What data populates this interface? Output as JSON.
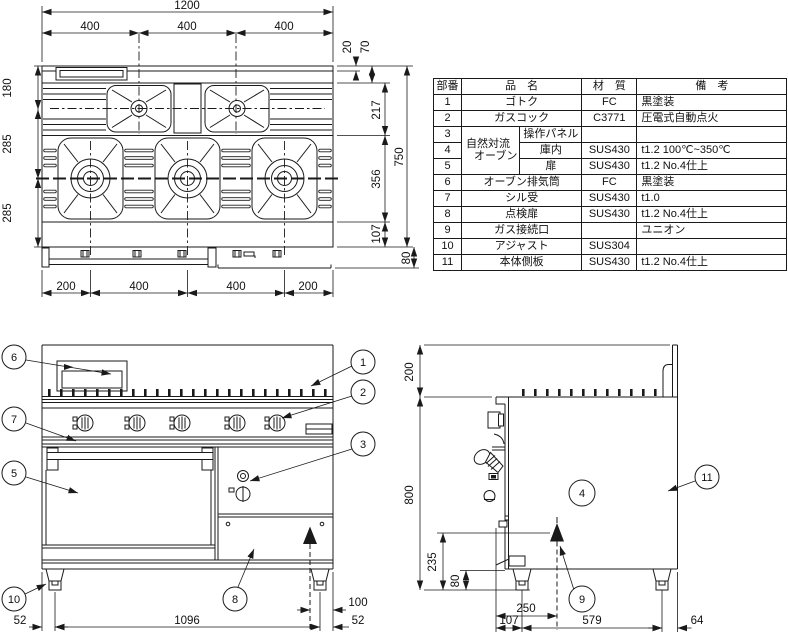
{
  "colors": {
    "line": "#1a1a1a",
    "background": "#ffffff"
  },
  "dims": {
    "plan": {
      "overall_width": "1200",
      "top_col_1": "400",
      "top_col_2": "400",
      "top_col_3": "400",
      "back_lip": "20",
      "back_band": "70",
      "left_1": "180",
      "left_2": "285",
      "left_3": "285",
      "right_1": "217",
      "right_2": "356",
      "right_3": "107",
      "overall_depth": "750",
      "front_rail": "80",
      "bottom_1": "200",
      "bottom_2": "400",
      "bottom_3": "400",
      "bottom_4": "200"
    },
    "front": {
      "leg_left": "52",
      "leg_span": "1096",
      "leg_right": "52",
      "gas_offset": "100"
    },
    "side": {
      "flue_height": "200",
      "body_height": "800",
      "gas_height": "235",
      "base_height": "80",
      "gas_depth": "250",
      "front_offset": "107",
      "leg_span": "579",
      "rear_offset": "64"
    }
  },
  "callouts": {
    "c1": "1",
    "c2": "2",
    "c3": "3",
    "c4": "4",
    "c5": "5",
    "c6": "6",
    "c7": "7",
    "c8": "8",
    "c9": "9",
    "c10": "10",
    "c11": "11"
  },
  "parts_table": {
    "headers": {
      "no": "部番",
      "name": "品　名",
      "material": "材　質",
      "note": "備　考"
    },
    "oven_group_line1": "自然対流",
    "oven_group_line2": "オーブン",
    "rows": [
      {
        "no": "1",
        "name": "ゴトク",
        "material": "FC",
        "note": "黒塗装"
      },
      {
        "no": "2",
        "name": "ガスコック",
        "material": "C3771",
        "note": "圧電式自動点火"
      },
      {
        "no": "3",
        "name": "操作パネル",
        "material": "",
        "note": ""
      },
      {
        "no": "4",
        "name": "庫内",
        "material": "SUS430",
        "note": "t1.2 100℃~350℃"
      },
      {
        "no": "5",
        "name": "扉",
        "material": "SUS430",
        "note": "t1.2 No.4仕上"
      },
      {
        "no": "6",
        "name": "オーブン排気筒",
        "material": "FC",
        "note": "黒塗装"
      },
      {
        "no": "7",
        "name": "シル受",
        "material": "SUS430",
        "note": "t1.0"
      },
      {
        "no": "8",
        "name": "点検扉",
        "material": "SUS430",
        "note": "t1.2 No.4仕上"
      },
      {
        "no": "9",
        "name": "ガス接続口",
        "material": "",
        "note": "ユニオン"
      },
      {
        "no": "10",
        "name": "アジャスト",
        "material": "SUS304",
        "note": ""
      },
      {
        "no": "11",
        "name": "本体側板",
        "material": "SUS430",
        "note": "t1.2 No.4仕上"
      }
    ]
  }
}
